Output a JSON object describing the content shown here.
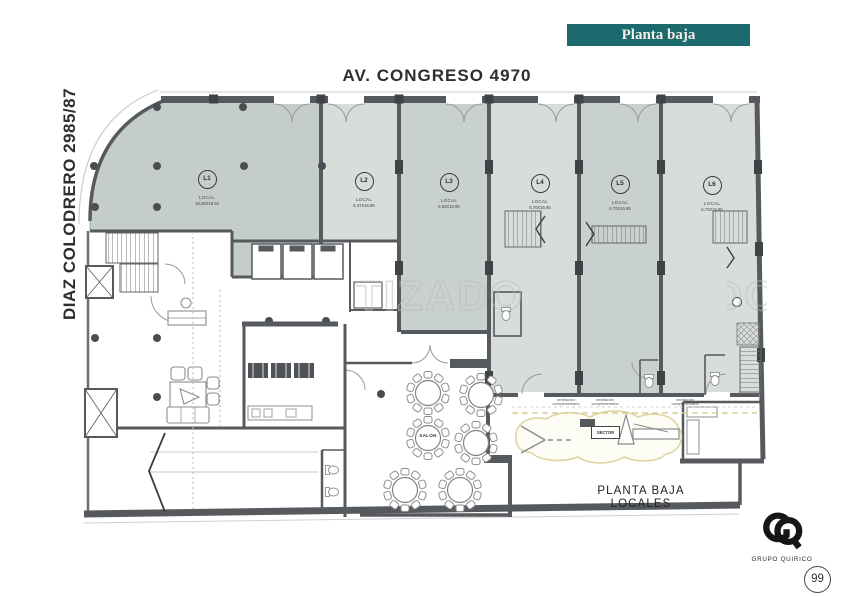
{
  "header": {
    "floor_badge": "Planta baja",
    "title": "AV. CONGRESO 4970"
  },
  "streets": {
    "left": "DIAZ COLODRERO 2985/87"
  },
  "watermark": {
    "text": "TIZADO"
  },
  "locals": [
    {
      "id": "L1",
      "type": "LOCAL",
      "dims": "16.28X18.94"
    },
    {
      "id": "L2",
      "type": "LOCAL",
      "dims": "5.47X16.95"
    },
    {
      "id": "L3",
      "type": "LOCAL",
      "dims": "5.92X16.95"
    },
    {
      "id": "L4",
      "type": "LOCAL",
      "dims": "6.70X16.95"
    },
    {
      "id": "L5",
      "type": "LOCAL",
      "dims": "6.70X16.95"
    },
    {
      "id": "L6",
      "type": "LOCAL",
      "dims": "6.73X16.95"
    }
  ],
  "plan_labels": {
    "salon": "SALON",
    "sector": "SECTOR",
    "vent_line1": "ventilación",
    "vent_line2": "complementaria"
  },
  "footer": {
    "caption_line1": "PLANTA BAJA",
    "caption_line2": "LOCALES",
    "brand": "GRUPO QUIRICO",
    "page_number": "99"
  },
  "colors": {
    "badge_bg": "#1c6a6d",
    "wall": "#565a5e",
    "local_fill_dark": "#c6cfcb",
    "local_fill_light": "#d7ddd9",
    "sector_outline": "#ddd3a0"
  }
}
